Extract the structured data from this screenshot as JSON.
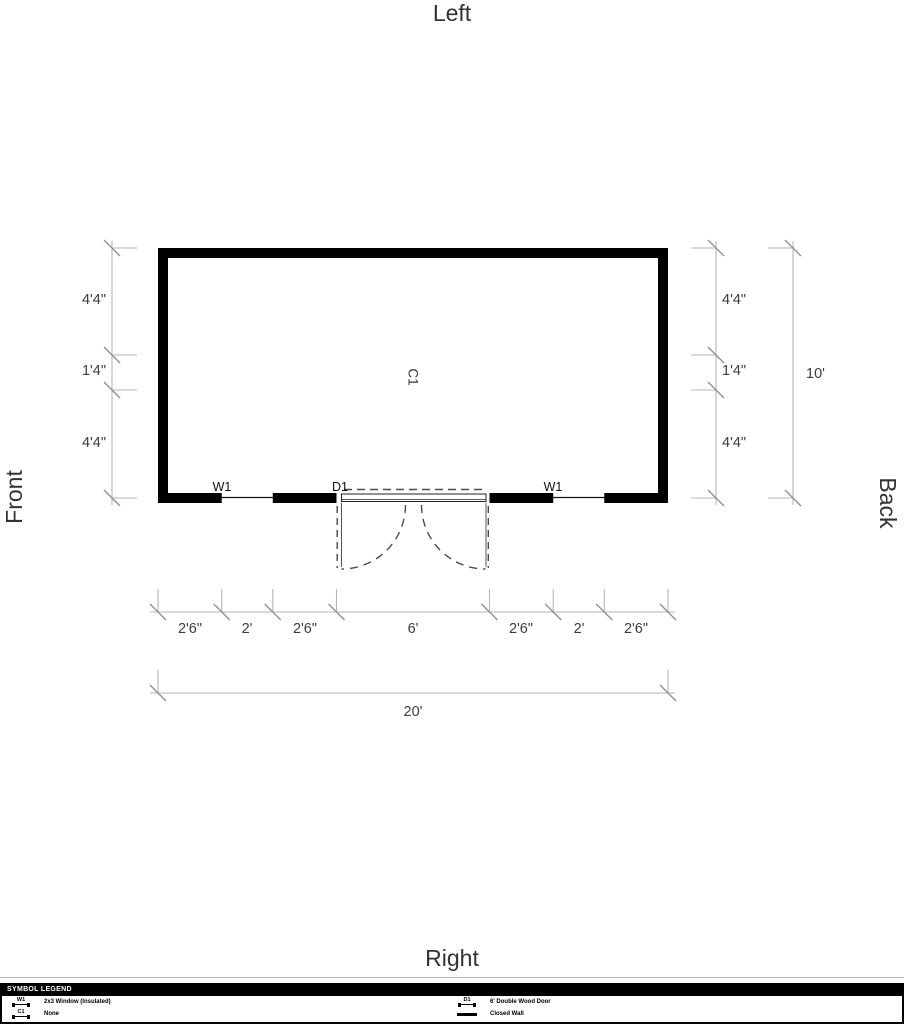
{
  "titles": {
    "top": "Left",
    "bottom": "Right",
    "left_side": "Front",
    "right_side": "Back"
  },
  "plan": {
    "area_label": "C1",
    "window_left_label": "W1",
    "door_label": "D1",
    "window_right_label": "W1"
  },
  "dims": {
    "left": [
      "4'4\"",
      "1'4\"",
      "4'4\""
    ],
    "right": [
      "4'4\"",
      "1'4\"",
      "4'4\""
    ],
    "right_total": "10'",
    "bottom": [
      "2'6\"",
      "2'",
      "2'6\"",
      "6'",
      "2'6\"",
      "2'",
      "2'6\""
    ],
    "bottom_total": "20'"
  },
  "legend": {
    "header": "SYMBOL LEGEND",
    "left_items": [
      {
        "symbol": "W1",
        "label": "2x3 Window (Insulated)"
      },
      {
        "symbol": "C1",
        "label": "None"
      }
    ],
    "right_items": [
      {
        "symbol": "D1",
        "label": "6' Double Wood Door"
      },
      {
        "symbol": "",
        "label": "Closed Wall"
      }
    ]
  },
  "colors": {
    "wall": "#000000",
    "dim_line": "#b6b6b6",
    "tick": "#8f8f8f",
    "text": "#3d3d3d",
    "door_dash": "#4a4a4a"
  }
}
